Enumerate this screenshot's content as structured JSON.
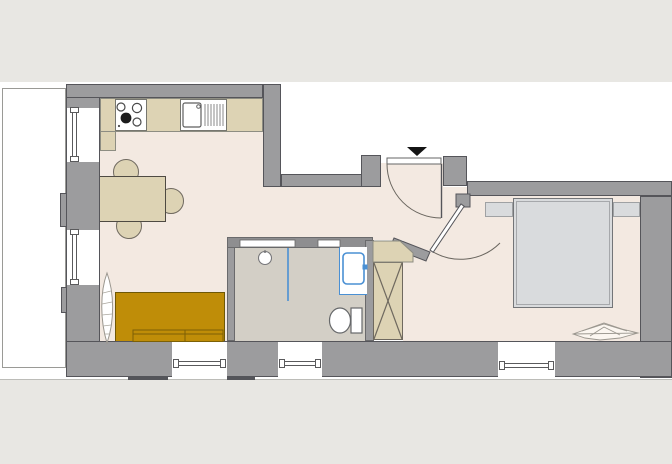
{
  "meta": {
    "kind": "apartment-floor-plan",
    "canvas_width_px": 672,
    "canvas_height_px": 464,
    "visible_text": "none"
  },
  "colors": {
    "white": "#ffffff",
    "outside": "#e8e7e3",
    "wall": "#9c9c9e",
    "outline": "#55555a",
    "floor": "#f3e9e1",
    "bathfloor": "#d3cfc6",
    "wood": "#ddd3b4",
    "woodline": "#8d8d82",
    "sofa": "#bf8d08",
    "sofaline": "#6e5806",
    "fixtureblue": "#4a90d4",
    "bed": "#d9dbdd",
    "bedline": "#737578",
    "entrymark": "#141414",
    "plantline": "#9a968e"
  },
  "rooms": [
    {
      "name": "living-kitchen"
    },
    {
      "name": "entry-hall"
    },
    {
      "name": "bathroom"
    },
    {
      "name": "bedroom"
    },
    {
      "name": "balcony-terrace"
    }
  ],
  "fixtures_and_furniture": [
    "cooktop-4-burners",
    "kitchen-sink-with-drainer",
    "kitchen-counter",
    "dining-table",
    "chair",
    "chair",
    "chair",
    "sofa-two-seat",
    "potted-plant-leaf",
    "shower-area-with-glass-screen",
    "floor-drain",
    "washbasin-blue",
    "toilet",
    "wardrobe-crossed",
    "corner-shelf",
    "double-bed",
    "nightstand-left",
    "nightstand-right",
    "decor-plant",
    "entry-door-swing",
    "bathroom-diagonal-door-swing",
    "entrance-triangle-marker",
    "window",
    "window",
    "window",
    "window",
    "window"
  ]
}
